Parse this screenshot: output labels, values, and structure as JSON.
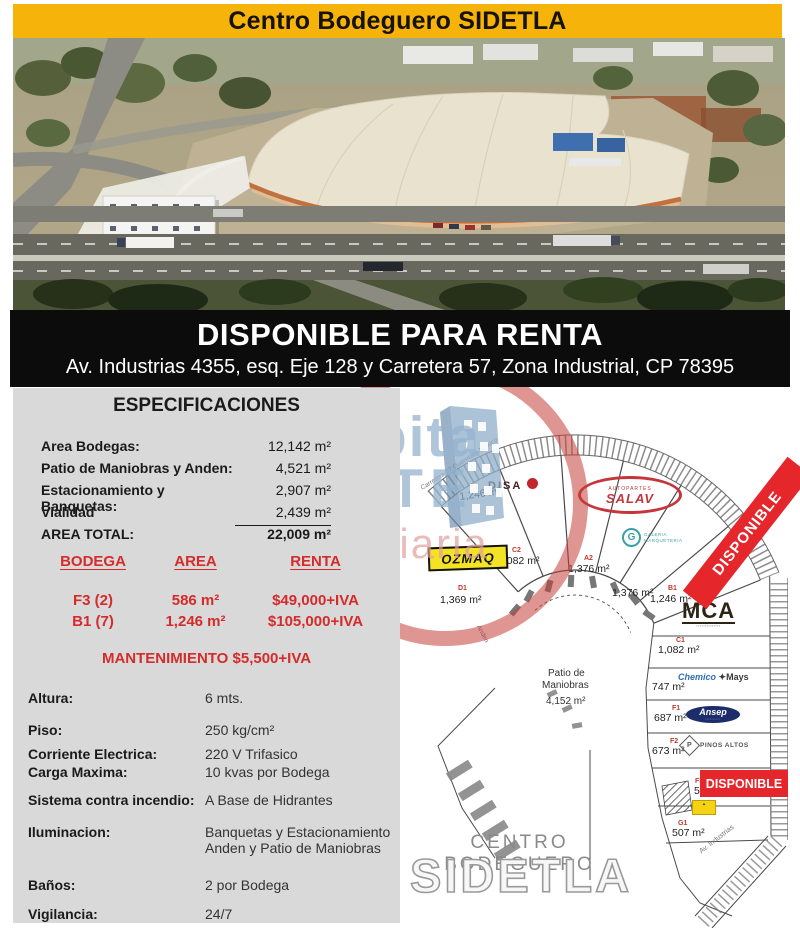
{
  "header": {
    "title": "Centro Bodeguero SIDETLA"
  },
  "banner": {
    "title": "DISPONIBLE PARA RENTA",
    "address": "Av. Industrias 4355, esq. Eje 128 y Carretera 57, Zona Industrial, CP 78395"
  },
  "especificaciones": {
    "title": "ESPECIFICACIONES",
    "areas": [
      {
        "label": "Area Bodegas:",
        "value": "12,142 m²"
      },
      {
        "label": "Patio de Maniobras y Anden:",
        "value": "4,521 m²"
      },
      {
        "label": "Estacionamiento y Banquetas:",
        "value": "2,907 m²"
      },
      {
        "label": "Vialidad",
        "value": "2,439 m²"
      },
      {
        "label": "AREA TOTAL:",
        "value": "22,009 m²"
      }
    ]
  },
  "rent_table": {
    "headers": [
      "BODEGA",
      "AREA",
      "RENTA"
    ],
    "rows": [
      {
        "bodega": "F3 (2)",
        "area": "586 m²",
        "renta": "$49,000+IVA"
      },
      {
        "bodega": "B1 (7)",
        "area": "1,246 m²",
        "renta": "$105,000+IVA"
      }
    ],
    "maintenance": "MANTENIMIENTO $5,500+IVA"
  },
  "details": [
    {
      "label": "Altura:",
      "value": "6 mts."
    },
    {
      "label": "Piso:",
      "value": "250 kg/cm²"
    },
    {
      "label": "Corriente Electrica:",
      "value": "220 V Trifasico"
    },
    {
      "label": "Carga Maxima:",
      "value": "10 kvas  por Bodega"
    },
    {
      "label": "Sistema contra incendio:",
      "value": "A Base de Hidrantes"
    },
    {
      "label": "Iluminacion:",
      "value": "Banquetas y Estacionamiento",
      "value2": "Anden y Patio de Maniobras"
    },
    {
      "label": "Baños:",
      "value": "2 por Bodega"
    },
    {
      "label": "Vigilancia:",
      "value": "24/7"
    }
  ],
  "watermark": {
    "line1": "Habita",
    "line2": "NORTE",
    "line3": "Inmobiliaria"
  },
  "site_plan": {
    "available_label": "DISPONIBLE",
    "road_label": "Carretera 57 Queretaro-Mexico",
    "anden_label": "Anden",
    "street_label": "Av. Industrias",
    "patio": {
      "line1": "Patio de",
      "line2": "Maniobras",
      "area": "4,152 m²"
    },
    "lots": [
      {
        "id": "",
        "area": "1,246 m²"
      },
      {
        "id": "C2",
        "area": "1,082 m²"
      },
      {
        "id": "A2",
        "area": "1,376 m²"
      },
      {
        "id": "",
        "area": "1,376 m²"
      },
      {
        "id": "D1",
        "area": "1,369 m²"
      },
      {
        "id": "B1",
        "area": "1,246 m²"
      },
      {
        "id": "C1",
        "area": "1,082 m²"
      },
      {
        "id": "",
        "area": "747 m²"
      },
      {
        "id": "F1",
        "area": "687 m²"
      },
      {
        "id": "F2",
        "area": "673 m²"
      },
      {
        "id": "F3",
        "area": "586 m²"
      },
      {
        "id": "G1",
        "area": "507 m²"
      }
    ],
    "tenants": {
      "disa": "DISA",
      "salav_top": "AUTOPARTES",
      "salav": "SALAV",
      "galeria_g": "G",
      "galeria_1": "GALERIA",
      "galeria_2": "MARQUETERIA",
      "ozmaq": "OZMAQ",
      "mca": "MCA",
      "chemico": "Chemico",
      "mays": "✦Mays",
      "ansep": "Ansep",
      "pinos_p": "P",
      "pinos": "PINOS ALTOS"
    },
    "footer": {
      "line1": "CENTRO BODEGUERO",
      "line2": "SIDETLA"
    }
  },
  "colors": {
    "header_yellow": "#F6B40B",
    "banner_black": "#0C0C0C",
    "panel_grey": "#D9D9D9",
    "accent_red": "#D42B2B",
    "ribbon_red": "#E5262B",
    "watermark_blue": "#94B2CD",
    "watermark_pink": "#E09E9E"
  }
}
